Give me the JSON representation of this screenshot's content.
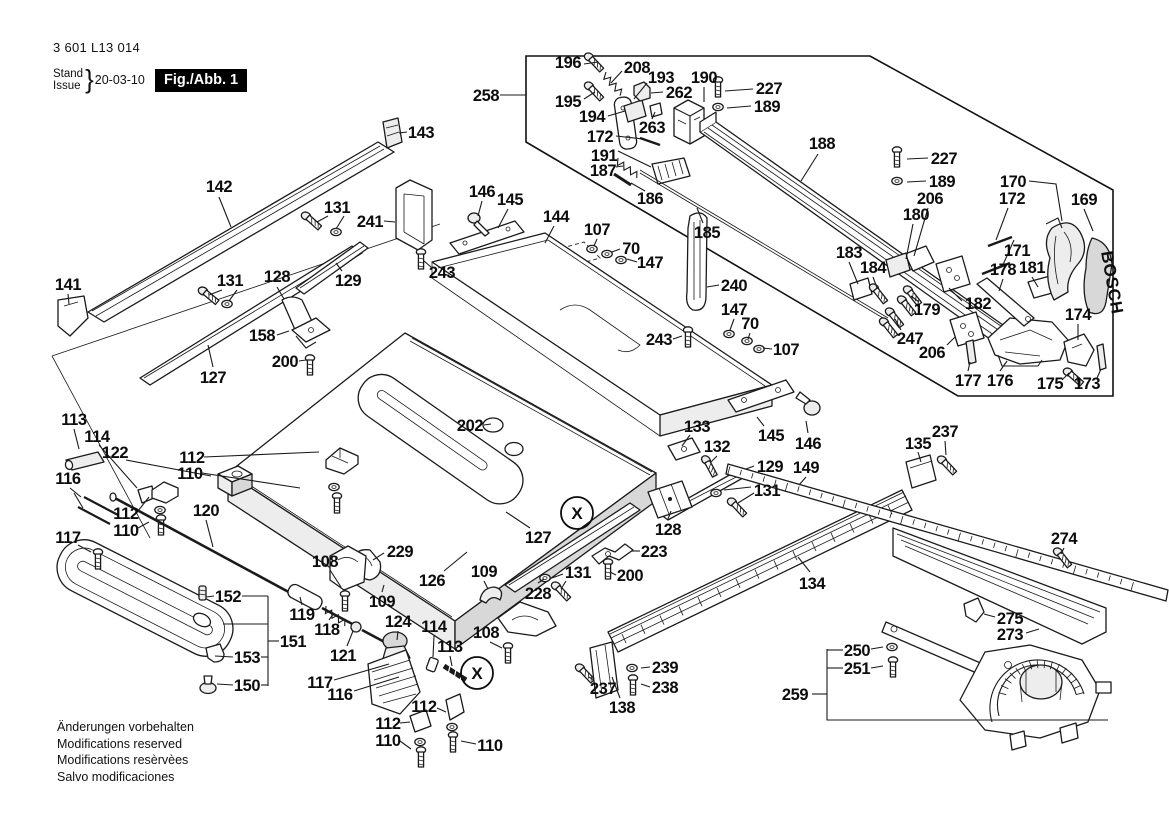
{
  "meta": {
    "part_number": "3 601 L13 014",
    "stand_label": "Stand",
    "issue_label": "Issue",
    "brace": "}",
    "date": "20-03-10",
    "fig_label": "Fig./Abb. 1"
  },
  "fence": {
    "brand": "BOSCH"
  },
  "footnotes": [
    "Änderungen vorbehalten",
    "Modifications reserved",
    "Modifications resèrvèes",
    "Salvo modificaciones"
  ],
  "section_markers": [
    {
      "label": "X",
      "x": 577,
      "y": 513
    },
    {
      "label": "X",
      "x": 477,
      "y": 673
    }
  ],
  "labels": [
    {
      "t": "258",
      "x": 486,
      "y": 95
    },
    {
      "t": "196",
      "x": 568,
      "y": 62
    },
    {
      "t": "208",
      "x": 637,
      "y": 67
    },
    {
      "t": "193",
      "x": 661,
      "y": 77
    },
    {
      "t": "190",
      "x": 704,
      "y": 77
    },
    {
      "t": "227",
      "x": 769,
      "y": 88
    },
    {
      "t": "189",
      "x": 767,
      "y": 106
    },
    {
      "t": "195",
      "x": 568,
      "y": 101
    },
    {
      "t": "262",
      "x": 679,
      "y": 92
    },
    {
      "t": "194",
      "x": 592,
      "y": 116
    },
    {
      "t": "263",
      "x": 652,
      "y": 127
    },
    {
      "t": "172",
      "x": 600,
      "y": 136
    },
    {
      "t": "191",
      "x": 604,
      "y": 155
    },
    {
      "t": "187",
      "x": 603,
      "y": 170
    },
    {
      "t": "186",
      "x": 650,
      "y": 198
    },
    {
      "t": "185",
      "x": 707,
      "y": 232
    },
    {
      "t": "188",
      "x": 822,
      "y": 143
    },
    {
      "t": "227",
      "x": 944,
      "y": 158
    },
    {
      "t": "189",
      "x": 942,
      "y": 181
    },
    {
      "t": "206",
      "x": 930,
      "y": 198
    },
    {
      "t": "180",
      "x": 916,
      "y": 214
    },
    {
      "t": "170",
      "x": 1013,
      "y": 181
    },
    {
      "t": "172",
      "x": 1012,
      "y": 198
    },
    {
      "t": "169",
      "x": 1084,
      "y": 199
    },
    {
      "t": "171",
      "x": 1017,
      "y": 250
    },
    {
      "t": "183",
      "x": 849,
      "y": 252
    },
    {
      "t": "184",
      "x": 873,
      "y": 267
    },
    {
      "t": "178",
      "x": 1003,
      "y": 269
    },
    {
      "t": "181",
      "x": 1032,
      "y": 267
    },
    {
      "t": "182",
      "x": 978,
      "y": 303
    },
    {
      "t": "179",
      "x": 927,
      "y": 309
    },
    {
      "t": "247",
      "x": 910,
      "y": 338
    },
    {
      "t": "206",
      "x": 932,
      "y": 352
    },
    {
      "t": "174",
      "x": 1078,
      "y": 314
    },
    {
      "t": "177",
      "x": 968,
      "y": 380
    },
    {
      "t": "176",
      "x": 1000,
      "y": 380
    },
    {
      "t": "175",
      "x": 1050,
      "y": 383
    },
    {
      "t": "173",
      "x": 1087,
      "y": 383
    },
    {
      "t": "143",
      "x": 421,
      "y": 132
    },
    {
      "t": "142",
      "x": 219,
      "y": 186
    },
    {
      "t": "131",
      "x": 337,
      "y": 207
    },
    {
      "t": "241",
      "x": 370,
      "y": 221
    },
    {
      "t": "146",
      "x": 482,
      "y": 191
    },
    {
      "t": "145",
      "x": 510,
      "y": 199
    },
    {
      "t": "144",
      "x": 556,
      "y": 216
    },
    {
      "t": "107",
      "x": 597,
      "y": 229
    },
    {
      "t": "70",
      "x": 631,
      "y": 248
    },
    {
      "t": "147",
      "x": 650,
      "y": 262
    },
    {
      "t": "243",
      "x": 442,
      "y": 272
    },
    {
      "t": "131",
      "x": 230,
      "y": 280
    },
    {
      "t": "128",
      "x": 277,
      "y": 276
    },
    {
      "t": "129",
      "x": 348,
      "y": 280
    },
    {
      "t": "141",
      "x": 68,
      "y": 284
    },
    {
      "t": "158",
      "x": 262,
      "y": 335
    },
    {
      "t": "200",
      "x": 285,
      "y": 361
    },
    {
      "t": "127",
      "x": 213,
      "y": 377
    },
    {
      "t": "240",
      "x": 734,
      "y": 285
    },
    {
      "t": "147",
      "x": 734,
      "y": 309
    },
    {
      "t": "70",
      "x": 750,
      "y": 323
    },
    {
      "t": "107",
      "x": 786,
      "y": 349
    },
    {
      "t": "243",
      "x": 659,
      "y": 339
    },
    {
      "t": "202",
      "x": 470,
      "y": 425
    },
    {
      "t": "133",
      "x": 697,
      "y": 426
    },
    {
      "t": "132",
      "x": 717,
      "y": 446
    },
    {
      "t": "145",
      "x": 771,
      "y": 435
    },
    {
      "t": "146",
      "x": 808,
      "y": 443
    },
    {
      "t": "129",
      "x": 770,
      "y": 466
    },
    {
      "t": "131",
      "x": 767,
      "y": 490
    },
    {
      "t": "149",
      "x": 806,
      "y": 467
    },
    {
      "t": "128",
      "x": 668,
      "y": 529
    },
    {
      "t": "135",
      "x": 918,
      "y": 443
    },
    {
      "t": "237",
      "x": 945,
      "y": 431
    },
    {
      "t": "113",
      "x": 74,
      "y": 419
    },
    {
      "t": "114",
      "x": 97,
      "y": 436
    },
    {
      "t": "122",
      "x": 115,
      "y": 452
    },
    {
      "t": "116",
      "x": 68,
      "y": 478
    },
    {
      "t": "112",
      "x": 192,
      "y": 457
    },
    {
      "t": "110",
      "x": 190,
      "y": 473
    },
    {
      "t": "112",
      "x": 126,
      "y": 513
    },
    {
      "t": "110",
      "x": 126,
      "y": 530
    },
    {
      "t": "117",
      "x": 68,
      "y": 537
    },
    {
      "t": "120",
      "x": 206,
      "y": 510
    },
    {
      "t": "108",
      "x": 325,
      "y": 561
    },
    {
      "t": "229",
      "x": 400,
      "y": 551
    },
    {
      "t": "126",
      "x": 432,
      "y": 580
    },
    {
      "t": "109",
      "x": 382,
      "y": 601
    },
    {
      "t": "119",
      "x": 302,
      "y": 614
    },
    {
      "t": "118",
      "x": 327,
      "y": 629
    },
    {
      "t": "121",
      "x": 343,
      "y": 655
    },
    {
      "t": "124",
      "x": 398,
      "y": 621
    },
    {
      "t": "114",
      "x": 434,
      "y": 626
    },
    {
      "t": "113",
      "x": 450,
      "y": 646
    },
    {
      "t": "152",
      "x": 228,
      "y": 596
    },
    {
      "t": "151",
      "x": 293,
      "y": 641
    },
    {
      "t": "153",
      "x": 247,
      "y": 657
    },
    {
      "t": "150",
      "x": 247,
      "y": 685
    },
    {
      "t": "117",
      "x": 320,
      "y": 682
    },
    {
      "t": "116",
      "x": 340,
      "y": 694
    },
    {
      "t": "127",
      "x": 538,
      "y": 537
    },
    {
      "t": "131",
      "x": 578,
      "y": 572
    },
    {
      "t": "228",
      "x": 538,
      "y": 593
    },
    {
      "t": "108",
      "x": 486,
      "y": 632
    },
    {
      "t": "109",
      "x": 484,
      "y": 571
    },
    {
      "t": "223",
      "x": 654,
      "y": 551
    },
    {
      "t": "200",
      "x": 630,
      "y": 575
    },
    {
      "t": "112",
      "x": 424,
      "y": 706
    },
    {
      "t": "112",
      "x": 388,
      "y": 723
    },
    {
      "t": "110",
      "x": 388,
      "y": 740
    },
    {
      "t": "110",
      "x": 490,
      "y": 745
    },
    {
      "t": "237",
      "x": 603,
      "y": 688
    },
    {
      "t": "239",
      "x": 665,
      "y": 667
    },
    {
      "t": "238",
      "x": 665,
      "y": 687
    },
    {
      "t": "138",
      "x": 622,
      "y": 707
    },
    {
      "t": "134",
      "x": 812,
      "y": 583
    },
    {
      "t": "274",
      "x": 1064,
      "y": 538
    },
    {
      "t": "275",
      "x": 1010,
      "y": 618
    },
    {
      "t": "273",
      "x": 1010,
      "y": 634
    },
    {
      "t": "250",
      "x": 857,
      "y": 650
    },
    {
      "t": "251",
      "x": 857,
      "y": 668
    },
    {
      "t": "259",
      "x": 795,
      "y": 694
    }
  ],
  "leaders": [
    [
      500,
      95,
      526,
      95
    ],
    [
      584,
      64,
      598,
      62
    ],
    [
      622,
      71,
      611,
      83
    ],
    [
      647,
      83,
      634,
      99
    ],
    [
      704,
      87,
      704,
      102
    ],
    [
      753,
      89,
      725,
      91
    ],
    [
      751,
      106,
      727,
      108
    ],
    [
      584,
      99,
      595,
      92
    ],
    [
      663,
      92,
      651,
      93
    ],
    [
      608,
      116,
      625,
      111
    ],
    [
      652,
      119,
      655,
      112
    ],
    [
      616,
      136,
      643,
      139
    ],
    [
      618,
      151,
      651,
      167
    ],
    [
      616,
      167,
      623,
      166
    ],
    [
      645,
      191,
      631,
      183
    ],
    [
      703,
      223,
      697,
      208
    ],
    [
      818,
      154,
      801,
      181
    ],
    [
      928,
      158,
      907,
      159
    ],
    [
      926,
      181,
      907,
      182
    ],
    [
      928,
      208,
      914,
      256
    ],
    [
      913,
      224,
      906,
      259
    ],
    [
      1029,
      181,
      1056,
      184,
      1062,
      221
    ],
    [
      1008,
      208,
      996,
      240
    ],
    [
      1084,
      209,
      1093,
      231
    ],
    [
      1014,
      240,
      1002,
      267
    ],
    [
      849,
      262,
      858,
      284
    ],
    [
      873,
      277,
      877,
      288
    ],
    [
      1003,
      279,
      999,
      291
    ],
    [
      1032,
      277,
      1038,
      287
    ],
    [
      962,
      301,
      949,
      288
    ],
    [
      919,
      302,
      911,
      296
    ],
    [
      901,
      330,
      895,
      319
    ],
    [
      947,
      345,
      955,
      337
    ],
    [
      1078,
      324,
      1078,
      340
    ],
    [
      968,
      371,
      970,
      362
    ],
    [
      1000,
      371,
      1007,
      361
    ],
    [
      1062,
      380,
      1069,
      373
    ],
    [
      1097,
      378,
      1101,
      369
    ],
    [
      407,
      132,
      399,
      133
    ],
    [
      219,
      197,
      231,
      227
    ],
    [
      328,
      216,
      317,
      222
    ],
    [
      344,
      216,
      336,
      229
    ],
    [
      384,
      221,
      395,
      222
    ],
    [
      482,
      201,
      478,
      216
    ],
    [
      508,
      209,
      498,
      228
    ],
    [
      554,
      226,
      545,
      243
    ],
    [
      597,
      239,
      594,
      246
    ],
    [
      620,
      249,
      612,
      252
    ],
    [
      637,
      262,
      627,
      259
    ],
    [
      431,
      267,
      424,
      261
    ],
    [
      222,
      290,
      209,
      295
    ],
    [
      237,
      290,
      229,
      301
    ],
    [
      277,
      287,
      284,
      299
    ],
    [
      342,
      271,
      336,
      263
    ],
    [
      68,
      294,
      69,
      304
    ],
    [
      277,
      335,
      289,
      331
    ],
    [
      299,
      361,
      306,
      360
    ],
    [
      213,
      367,
      208,
      345
    ],
    [
      719,
      285,
      707,
      287
    ],
    [
      734,
      319,
      730,
      330
    ],
    [
      750,
      333,
      748,
      339
    ],
    [
      772,
      349,
      763,
      348
    ],
    [
      673,
      339,
      682,
      336
    ],
    [
      484,
      425,
      491,
      424
    ],
    [
      690,
      435,
      682,
      446
    ],
    [
      717,
      456,
      710,
      463
    ],
    [
      764,
      426,
      757,
      417
    ],
    [
      808,
      433,
      806,
      421
    ],
    [
      754,
      466,
      746,
      469
    ],
    [
      751,
      487,
      724,
      490
    ],
    [
      754,
      493,
      738,
      503
    ],
    [
      806,
      477,
      799,
      485
    ],
    [
      668,
      519,
      671,
      511
    ],
    [
      918,
      452,
      921,
      462
    ],
    [
      945,
      441,
      946,
      455
    ],
    [
      74,
      429,
      79,
      449
    ],
    [
      99,
      445,
      137,
      488
    ],
    [
      126,
      460,
      211,
      476
    ],
    [
      70,
      488,
      81,
      497
    ],
    [
      74,
      493,
      83,
      508
    ],
    [
      204,
      457,
      319,
      452
    ],
    [
      202,
      473,
      300,
      488
    ],
    [
      138,
      511,
      149,
      497
    ],
    [
      138,
      528,
      149,
      522
    ],
    [
      78,
      545,
      91,
      552
    ],
    [
      206,
      520,
      213,
      547
    ],
    [
      330,
      570,
      341,
      587
    ],
    [
      384,
      553,
      373,
      560
    ],
    [
      444,
      571,
      467,
      552
    ],
    [
      382,
      592,
      384,
      585
    ],
    [
      302,
      605,
      300,
      597
    ],
    [
      329,
      620,
      334,
      613
    ],
    [
      347,
      646,
      353,
      631
    ],
    [
      398,
      631,
      397,
      640
    ],
    [
      434,
      636,
      433,
      657
    ],
    [
      450,
      656,
      452,
      666
    ],
    [
      334,
      680,
      389,
      664
    ],
    [
      354,
      691,
      399,
      677
    ],
    [
      214,
      596,
      206,
      597
    ],
    [
      242,
      596,
      268,
      596
    ],
    [
      268,
      596,
      268,
      686
    ],
    [
      261,
      657,
      268,
      657
    ],
    [
      261,
      685,
      268,
      685
    ],
    [
      279,
      641,
      268,
      641
    ],
    [
      233,
      657,
      215,
      656
    ],
    [
      233,
      685,
      217,
      684
    ],
    [
      223,
      624,
      268,
      624
    ],
    [
      530,
      528,
      506,
      512
    ],
    [
      563,
      574,
      552,
      578
    ],
    [
      566,
      581,
      561,
      589
    ],
    [
      538,
      583,
      544,
      579
    ],
    [
      490,
      642,
      502,
      648
    ],
    [
      484,
      581,
      488,
      589
    ],
    [
      640,
      551,
      631,
      551
    ],
    [
      616,
      575,
      610,
      572
    ],
    [
      437,
      708,
      446,
      712
    ],
    [
      400,
      723,
      410,
      722
    ],
    [
      400,
      741,
      411,
      749
    ],
    [
      476,
      744,
      461,
      741
    ],
    [
      594,
      680,
      589,
      677
    ],
    [
      650,
      667,
      641,
      668
    ],
    [
      650,
      687,
      641,
      684
    ],
    [
      620,
      698,
      612,
      677
    ],
    [
      810,
      572,
      798,
      557
    ],
    [
      1064,
      548,
      1061,
      554
    ],
    [
      995,
      617,
      984,
      614
    ],
    [
      1026,
      633,
      1039,
      629
    ],
    [
      871,
      649,
      883,
      647
    ],
    [
      871,
      668,
      883,
      666
    ],
    [
      812,
      694,
      827,
      694
    ],
    [
      827,
      649,
      827,
      720,
      1108,
      720
    ],
    [
      827,
      650,
      843,
      650
    ],
    [
      827,
      668,
      843,
      668
    ]
  ]
}
